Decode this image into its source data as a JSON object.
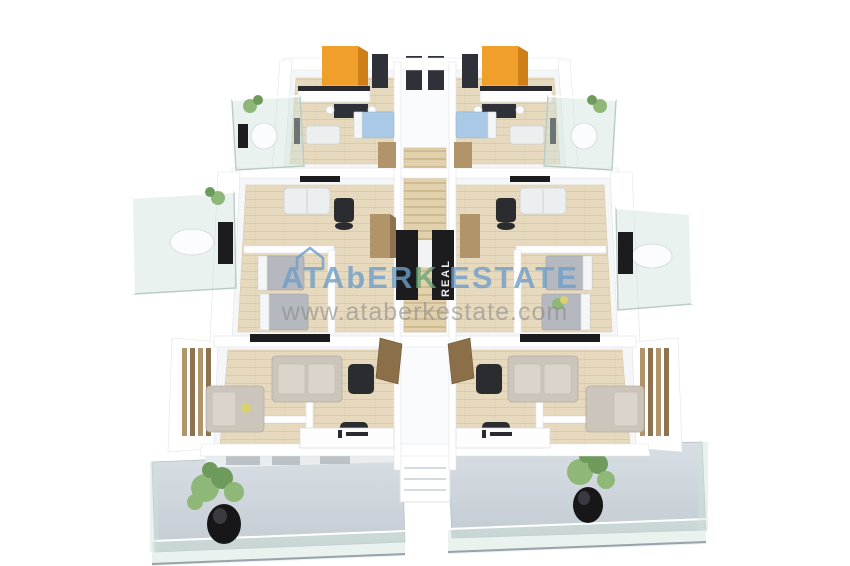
{
  "watermark": {
    "brand_part1": "ATAbER",
    "brand_accent": "K",
    "brand_part2": " ESTATE",
    "url": "www.ataberkestate.com",
    "door_label": "REAL"
  },
  "scene": {
    "description": "3D rendered real-estate floor plan of a symmetric apartment storey with four units, central staircase corridor, glass balconies and bottom terraces with potted plants"
  },
  "colors": {
    "background": "#ffffff",
    "watermark_blue": "#6d9ec9",
    "watermark_green": "#69a877",
    "watermark_gray": "#8a8a8a",
    "wardrobe_orange": "#f09f2a",
    "wardrobe_tan": "#b2946a",
    "wood_floor": "#e7d9bd",
    "terrace_gray": "#ccd4db",
    "glass": "#cfe2da",
    "bed_blue": "#a9c9e6",
    "bed_gray": "#b5b8bf",
    "sofa_white": "#eceff0",
    "sofa_beige": "#ccc5bc",
    "armchair_black": "#2a2c30",
    "door_brown": "#8a6f48",
    "panel_black": "#1c1c1f",
    "plant_green": "#8fb878",
    "pot_black": "#17171a"
  }
}
